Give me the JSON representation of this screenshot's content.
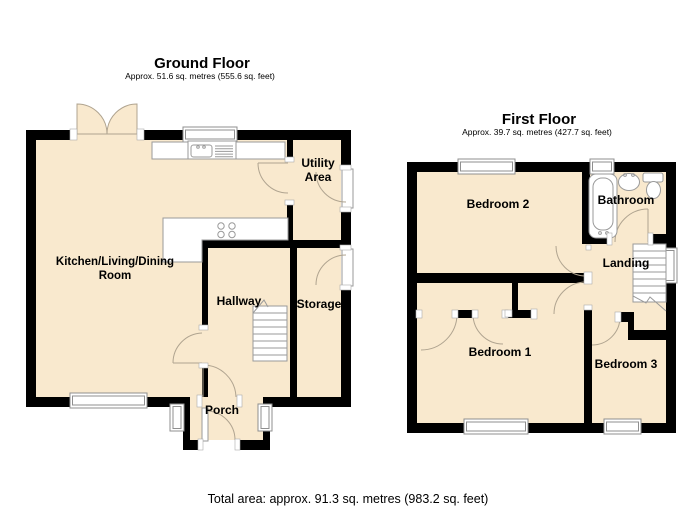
{
  "ground_floor": {
    "title": "Ground Floor",
    "area": "Approx. 51.6 sq. metres (555.6 sq. feet)",
    "rooms": {
      "kitchen_living_dining": {
        "label_line1": "Kitchen/Living/Dining",
        "label_line2": "Room"
      },
      "hallway": {
        "label": "Hallway"
      },
      "storage": {
        "label": "Storage"
      },
      "utility": {
        "label_line1": "Utility",
        "label_line2": "Area"
      },
      "porch": {
        "label": "Porch"
      }
    },
    "icons": [
      "french-doors-icon",
      "kitchen-sink-icon",
      "hob-icon",
      "stairs-icon",
      "window-icon",
      "door-arc-icon"
    ]
  },
  "first_floor": {
    "title": "First Floor",
    "area": "Approx. 39.7 sq. metres (427.7 sq. feet)",
    "rooms": {
      "bedroom2": {
        "label": "Bedroom 2"
      },
      "bathroom": {
        "label": "Bathroom"
      },
      "landing": {
        "label": "Landing"
      },
      "bedroom1": {
        "label": "Bedroom 1"
      },
      "bedroom3": {
        "label": "Bedroom 3"
      }
    },
    "icons": [
      "bath-icon",
      "basin-icon",
      "toilet-icon",
      "stairs-icon",
      "wardrobe-doors-icon",
      "window-icon"
    ]
  },
  "footer": {
    "total_area": "Total area: approx. 91.3 sq. metres (983.2 sq. feet)"
  },
  "colors": {
    "wall": "#000000",
    "floor_fill": "#f9e9ce",
    "detail_line": "#9a9a9a",
    "text": "#000000",
    "background": "#ffffff"
  }
}
